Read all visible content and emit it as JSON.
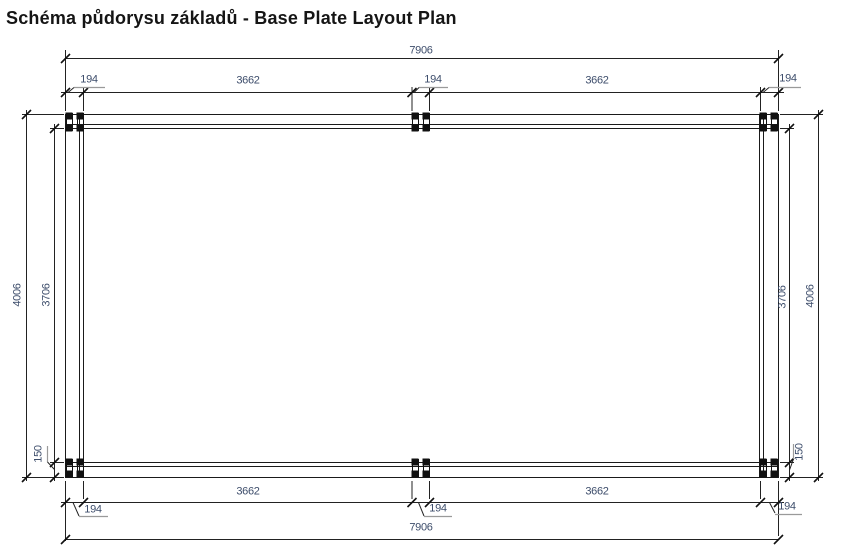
{
  "title": "Schéma půdorysu základů - Base Plate Layout Plan",
  "dims": {
    "total_width": "7906",
    "bay_width": "3662",
    "post_width": "194",
    "total_height": "4006",
    "clear_height": "3706",
    "edge_offset": "150"
  },
  "colors": {
    "line": "#1a1a1a",
    "dim_text": "#3d4d6b",
    "leader_underline": "#9a9a9a",
    "background": "#ffffff"
  }
}
